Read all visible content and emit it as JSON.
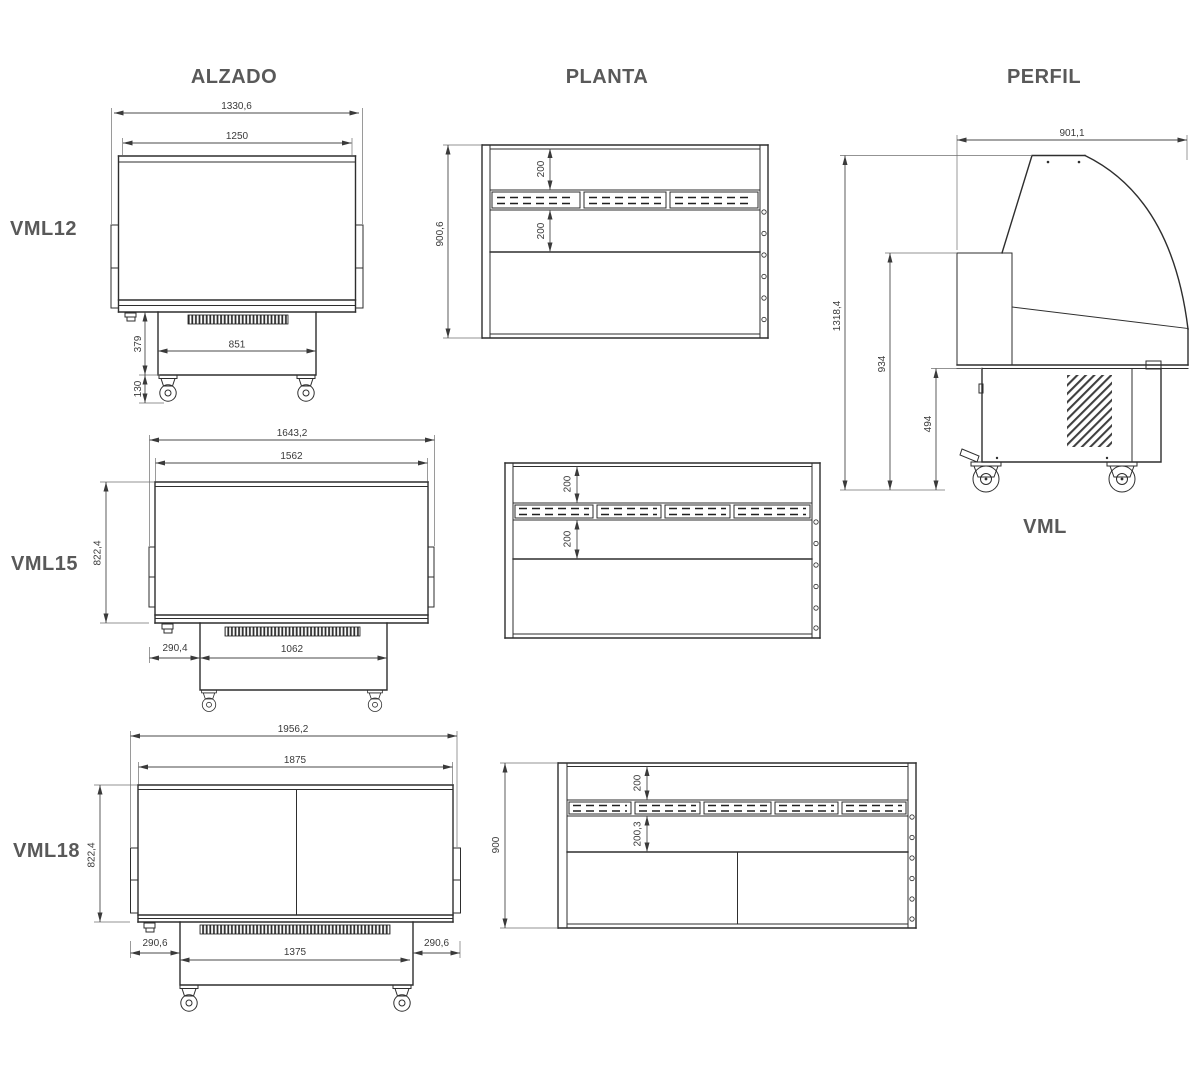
{
  "titles": {
    "alzado": "ALZADO",
    "planta": "PLANTA",
    "perfil": "PERFIL"
  },
  "views": {
    "vml12": {
      "label": "VML12",
      "alzado": {
        "total_width": "1330,6",
        "display_width": "1250",
        "base_height": "379",
        "base_width": "851",
        "caster_height": "130"
      },
      "planta": {
        "total_depth": "900,6",
        "rear_ledge_depth": "200",
        "well_depth": "200"
      }
    },
    "vml15": {
      "label": "VML15",
      "alzado": {
        "total_width": "1643,2",
        "display_width": "1562",
        "body_height": "822,4",
        "base_inset": "290,4",
        "base_width": "1062"
      },
      "planta": {
        "rear_ledge_depth": "200",
        "well_depth": "200"
      }
    },
    "vml18": {
      "label": "VML18",
      "alzado": {
        "total_width": "1956,2",
        "display_width": "1875",
        "body_height": "822,4",
        "base_inset_left": "290,6",
        "base_width": "1375",
        "base_inset_right": "290,6"
      },
      "planta": {
        "total_depth": "900",
        "rear_ledge_depth": "200",
        "well_depth": "200,3"
      }
    },
    "perfil": {
      "model_label": "VML",
      "total_depth": "901,1",
      "total_height": "1318,4",
      "counter_height": "934",
      "base_height": "494"
    }
  }
}
